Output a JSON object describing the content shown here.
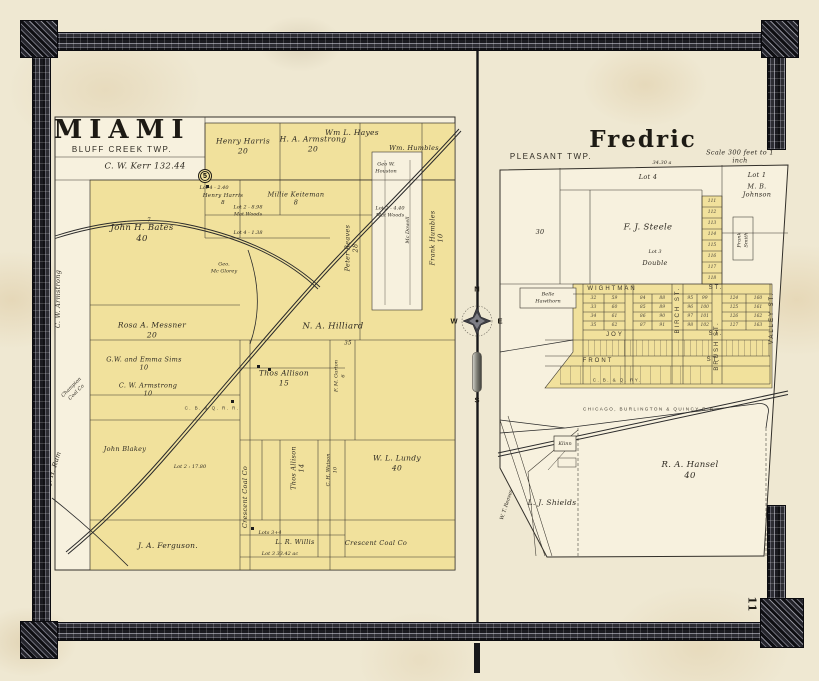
{
  "page": {
    "number": "11"
  },
  "compass": {
    "north": "N",
    "west": "W",
    "east": "E",
    "south": "S"
  },
  "miami": {
    "title": "MIAMI",
    "subtitle": "BLUFF CREEK TWP.",
    "labels": {
      "kerr": "C. W. Kerr      132.44",
      "henry_harris": "Henry Harris\n20",
      "armstrong20": "H. A. Armstrong\n20",
      "hayes": "Wm L. Hayes",
      "humbles": "Wm. Humbles",
      "houston": "Geo W.\nHouston",
      "five": "5",
      "lot4_240": "Lot 4 - 2.40",
      "harris8": "Henry Harris\n8",
      "keiteman": "Millie Keiteman\n8",
      "matwoods1": "Lot 2 - 8.98\nMat Woods",
      "lot4_138": "Lot 4 - 1.38",
      "matwoods2": "Lot 2 - 4.40\nMat Woods",
      "bates": "John H. Bates\n40",
      "seven": "7",
      "mcglorey": "Geo.\nMc Glorey",
      "reaves": "Peter Reaves\n28",
      "mcdowell": "Mc Dowell",
      "frank_humbles": "Frank Humbles\n10",
      "messner": "Rosa A. Messner\n20",
      "hilliard": "N. A. Hilliard",
      "hilliard_acres": "35",
      "sims": "G.W. and Emma Sims\n10",
      "armstrong10": "C. W. Armstrong\n10",
      "allison15": "Thos Allison\n15",
      "gurton": "F. M. Gurton\n6",
      "blakey": "John Blakey",
      "lot2_1780": "Lot 2 : 17.80",
      "allison14": "Thos Allison\n14",
      "watson": "C. H. Watson\n10",
      "lundy": "W. L. Lundy\n40",
      "crescent_v": "Crescent Coal Co",
      "ferguson": "J. A. Ferguson.",
      "lots34": "Lots 3+4",
      "willis": "L. R. Willis",
      "lot3_3342": "Lot 3   33.42 ac",
      "crescent_h": "Crescent Coal Co",
      "armstrong_edge": "C. W. Armstrong",
      "rum": "J. H. Rum",
      "champion": "Champion\nCoal Co",
      "railroad": "C. B. & Q. R. R."
    }
  },
  "fredric": {
    "title": "Fredric",
    "township": "PLEASANT TWP.",
    "scale_note": "Scale 300 feet to 1 inch",
    "labels": {
      "lot4": "Lot 4",
      "acres3430": "34.30 a",
      "lot1": "Lot 1",
      "johnson": "M. B.\nJohnson",
      "steele": "F. J. Steele",
      "thirty": "30",
      "lot3": "Lot 3",
      "double": "Double",
      "smith": "Frank\nSmith",
      "hawthorn": "Belle\nHawthorn",
      "klinn": "Klinn",
      "hansel": "R. A. Hansel\n40",
      "shields": "L. J. Shields",
      "reaves_edge": "W. T. Reaves"
    },
    "streets": {
      "wightman": "WIGHTMAN",
      "joy": "JOY",
      "front": "FRONT",
      "st": "ST.",
      "birch": "BIRCH ST.",
      "brush": "BRUSH ST.",
      "valley": "VALLEY ST."
    },
    "railroads": {
      "cbq_short": "C. B. & Q. RY.",
      "cbq_full": "CHICAGO, BURLINGTON & QUINCY R.R."
    },
    "strip_lots": [
      "111",
      "112",
      "113",
      "114",
      "115",
      "116",
      "117",
      "118"
    ],
    "blocks": [
      {
        "lots": [
          "32",
          "59",
          "33",
          "60",
          "34",
          "61",
          "35",
          "62"
        ]
      },
      {
        "lots": [
          "84",
          "88",
          "85",
          "89",
          "86",
          "90",
          "87",
          "91"
        ]
      },
      {
        "lots": [
          "95",
          "99",
          "96",
          "100",
          "97",
          "101",
          "98",
          "102"
        ]
      },
      {
        "lots": [
          "124",
          "160",
          "125",
          "161",
          "126",
          "162",
          "127",
          "163"
        ]
      }
    ]
  }
}
